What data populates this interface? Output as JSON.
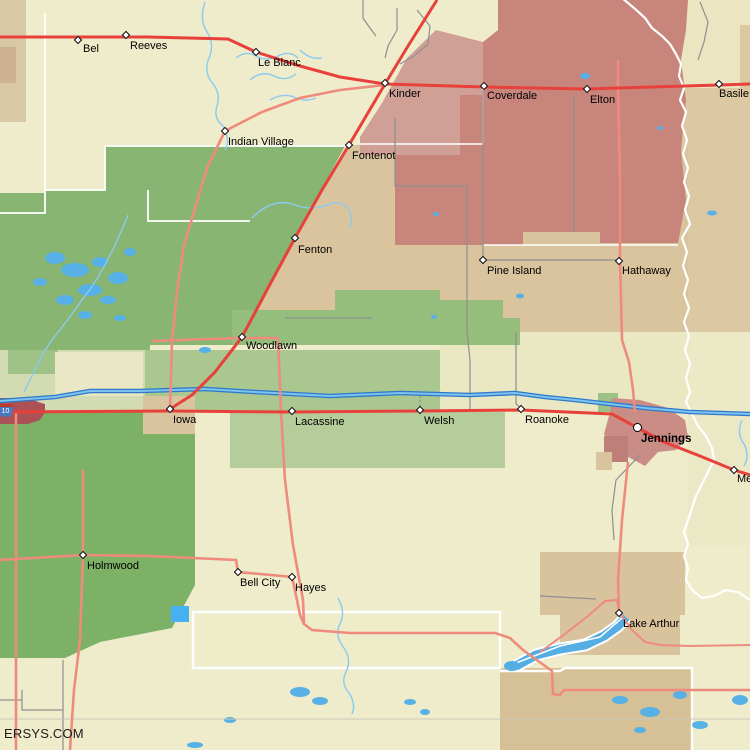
{
  "watermark": "ERSYS.COM",
  "map": {
    "shield_label": "10",
    "towns": [
      {
        "name": "Bel",
        "x": 78,
        "y": 40,
        "dx": 5,
        "dy": 4,
        "kind": "dot"
      },
      {
        "name": "Reeves",
        "x": 126,
        "y": 35,
        "dx": 4,
        "dy": 6,
        "kind": "dot"
      },
      {
        "name": "Le Blanc",
        "x": 256,
        "y": 52,
        "dx": 2,
        "dy": 6,
        "kind": "dot"
      },
      {
        "name": "Kinder",
        "x": 385,
        "y": 83,
        "dx": 4,
        "dy": 6,
        "kind": "dot"
      },
      {
        "name": "Coverdale",
        "x": 484,
        "y": 86,
        "dx": 3,
        "dy": 5,
        "kind": "dot"
      },
      {
        "name": "Elton",
        "x": 587,
        "y": 89,
        "dx": 3,
        "dy": 6,
        "kind": "dot"
      },
      {
        "name": "Basile",
        "x": 719,
        "y": 84,
        "dx": 0,
        "dy": 5,
        "kind": "dot"
      },
      {
        "name": "Indian Village",
        "x": 225,
        "y": 131,
        "dx": 3,
        "dy": 6,
        "kind": "dot"
      },
      {
        "name": "Fontenot",
        "x": 349,
        "y": 145,
        "dx": 3,
        "dy": 6,
        "kind": "dot"
      },
      {
        "name": "Fenton",
        "x": 295,
        "y": 238,
        "dx": 3,
        "dy": 7,
        "kind": "dot"
      },
      {
        "name": "Pine Island",
        "x": 483,
        "y": 260,
        "dx": 4,
        "dy": 6,
        "kind": "dot"
      },
      {
        "name": "Hathaway",
        "x": 619,
        "y": 261,
        "dx": 3,
        "dy": 5,
        "kind": "dot"
      },
      {
        "name": "Woodlawn",
        "x": 242,
        "y": 337,
        "dx": 4,
        "dy": 4,
        "kind": "dot"
      },
      {
        "name": "Iowa",
        "x": 170,
        "y": 409,
        "dx": 3,
        "dy": 6,
        "kind": "dot"
      },
      {
        "name": "Lacassine",
        "x": 292,
        "y": 411,
        "dx": 3,
        "dy": 6,
        "kind": "dot"
      },
      {
        "name": "Welsh",
        "x": 420,
        "y": 410,
        "dx": 4,
        "dy": 6,
        "kind": "dot"
      },
      {
        "name": "Roanoke",
        "x": 521,
        "y": 409,
        "dx": 4,
        "dy": 6,
        "kind": "dot"
      },
      {
        "name": "Jennings",
        "x": 638,
        "y": 428,
        "dx": 3,
        "dy": 6,
        "kind": "city"
      },
      {
        "name": "Me",
        "x": 734,
        "y": 470,
        "dx": 3,
        "dy": 4,
        "kind": "dot"
      },
      {
        "name": "Holmwood",
        "x": 83,
        "y": 555,
        "dx": 4,
        "dy": 6,
        "kind": "dot"
      },
      {
        "name": "Bell City",
        "x": 238,
        "y": 572,
        "dx": 2,
        "dy": 6,
        "kind": "dot"
      },
      {
        "name": "Hayes",
        "x": 292,
        "y": 577,
        "dx": 3,
        "dy": 6,
        "kind": "dot"
      },
      {
        "name": "Lake Arthur",
        "x": 619,
        "y": 613,
        "dx": 4,
        "dy": 6,
        "kind": "dot"
      }
    ],
    "palette": {
      "cream": "#eeeccb",
      "tan": "#d9c49e",
      "tan_dark": "#d6c096",
      "tan_light": "#dcc9a4",
      "green_dark": "#7cb166",
      "green_main": "#88b571",
      "green_mid": "#95bd7c",
      "sage": "#adc891",
      "sage_pale": "#d7dcb0",
      "red_dark": "#c8857c",
      "pink": "#d0a097",
      "jennings_pink": "#ca8d85",
      "edge_red": "#ab5257",
      "road_red": "#e8403a",
      "road_salmon": "#ef8b7d",
      "road_gray": "#8f8f8f",
      "water": "#55aee6",
      "water_dark": "#2e79c9",
      "boundary_white": "#ffffff"
    }
  }
}
